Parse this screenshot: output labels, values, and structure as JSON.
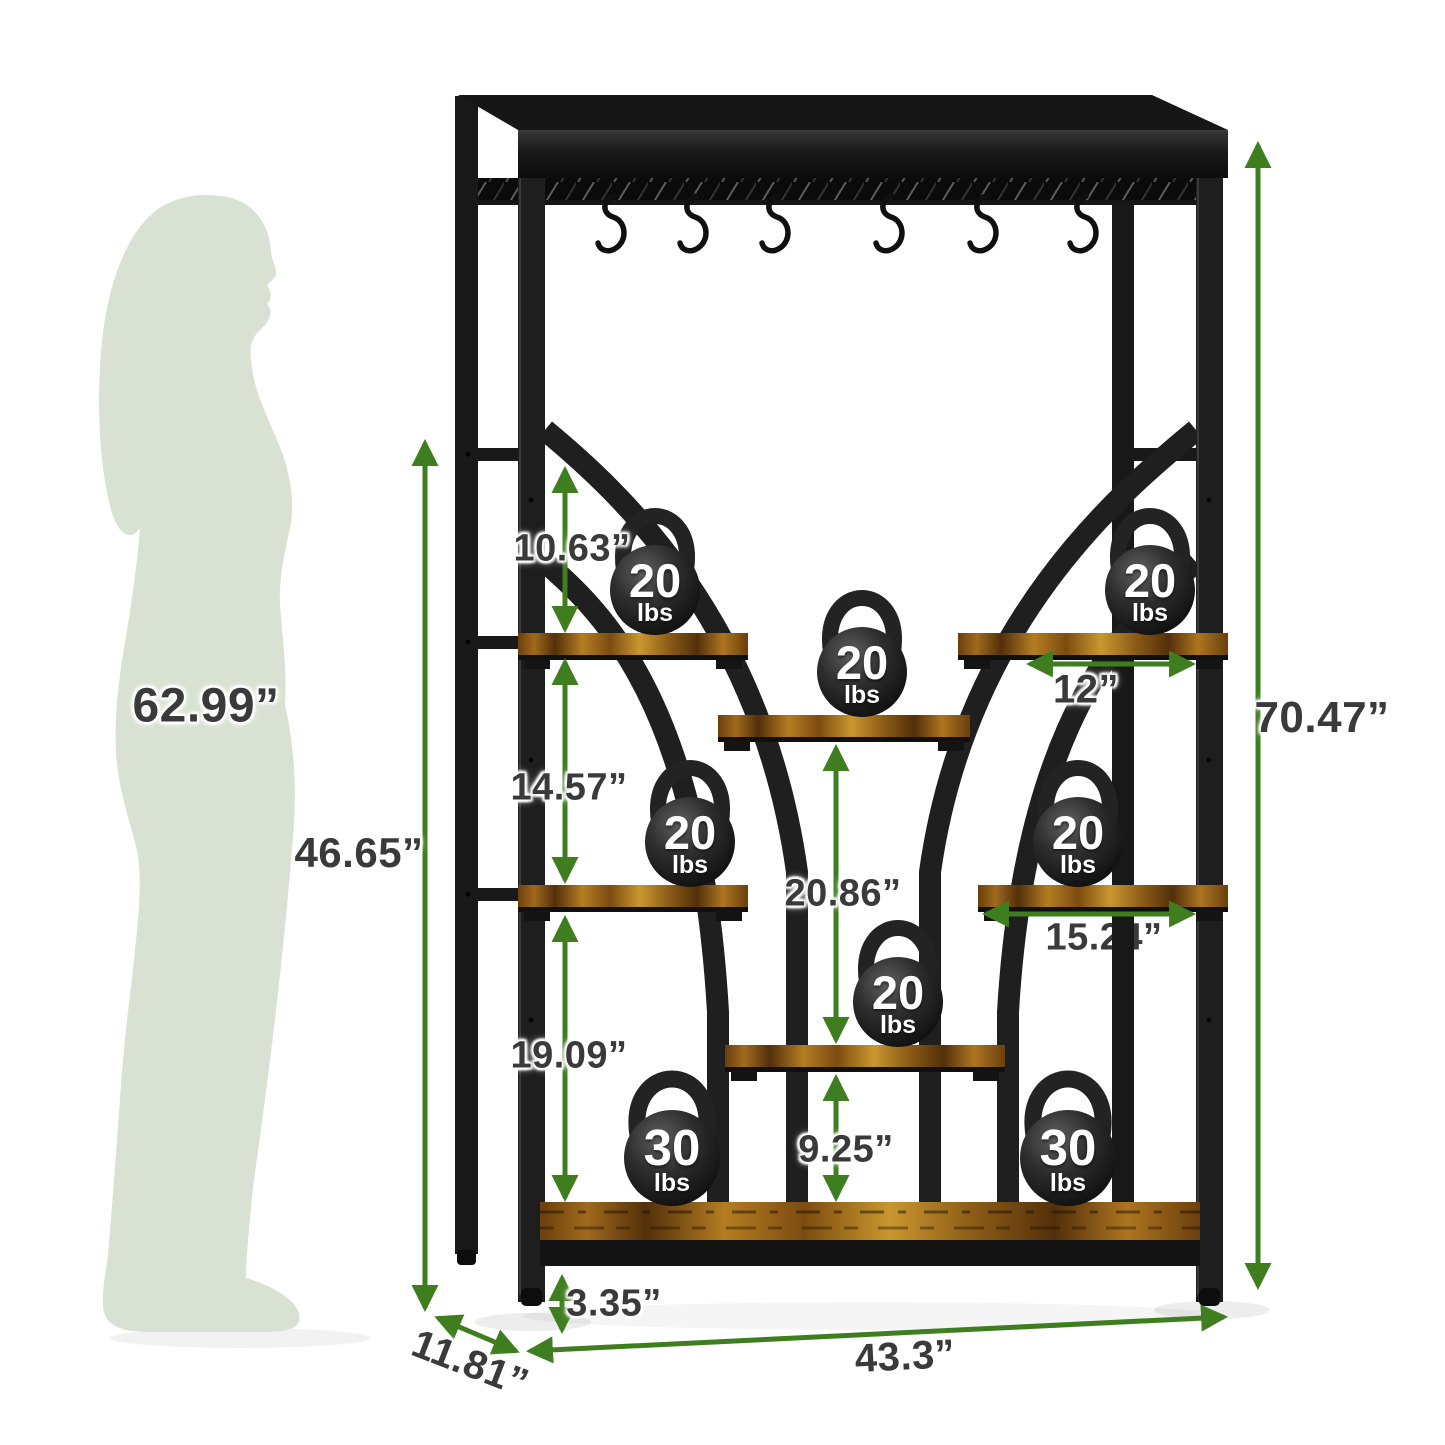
{
  "person": {
    "height": "62.99”"
  },
  "rack": {
    "overall_height": "70.47”",
    "overall_width": "43.3”",
    "depth": "11.81”",
    "inner_height": "46.65”",
    "top_shelf_gap": "10.63”",
    "middle_shelf_gap": "14.57”",
    "bottom_shelf_gap": "19.09”",
    "center_column_height": "20.86”",
    "center_bottom_gap": "9.25”",
    "side_shelf_width": "12”",
    "middle_shelf_width": "15.24”",
    "ground_clearance": "3.35”",
    "hook_count": 6
  },
  "kettlebells": [
    {
      "id": "top-left",
      "weight": "20",
      "unit": "lbs"
    },
    {
      "id": "top-right",
      "weight": "20",
      "unit": "lbs"
    },
    {
      "id": "upper-center",
      "weight": "20",
      "unit": "lbs"
    },
    {
      "id": "middle-left",
      "weight": "20",
      "unit": "lbs"
    },
    {
      "id": "middle-right",
      "weight": "20",
      "unit": "lbs"
    },
    {
      "id": "lower-center",
      "weight": "20",
      "unit": "lbs"
    },
    {
      "id": "bottom-left",
      "weight": "30",
      "unit": "lbs"
    },
    {
      "id": "bottom-right",
      "weight": "30",
      "unit": "lbs"
    }
  ],
  "colors": {
    "dimension_green": "#3f7e1f",
    "label_gray": "#3a3a3a",
    "silhouette_green": "#d9e2d2",
    "metal_black": "#1d1d1d",
    "wood_brown": "#8a5a16"
  }
}
